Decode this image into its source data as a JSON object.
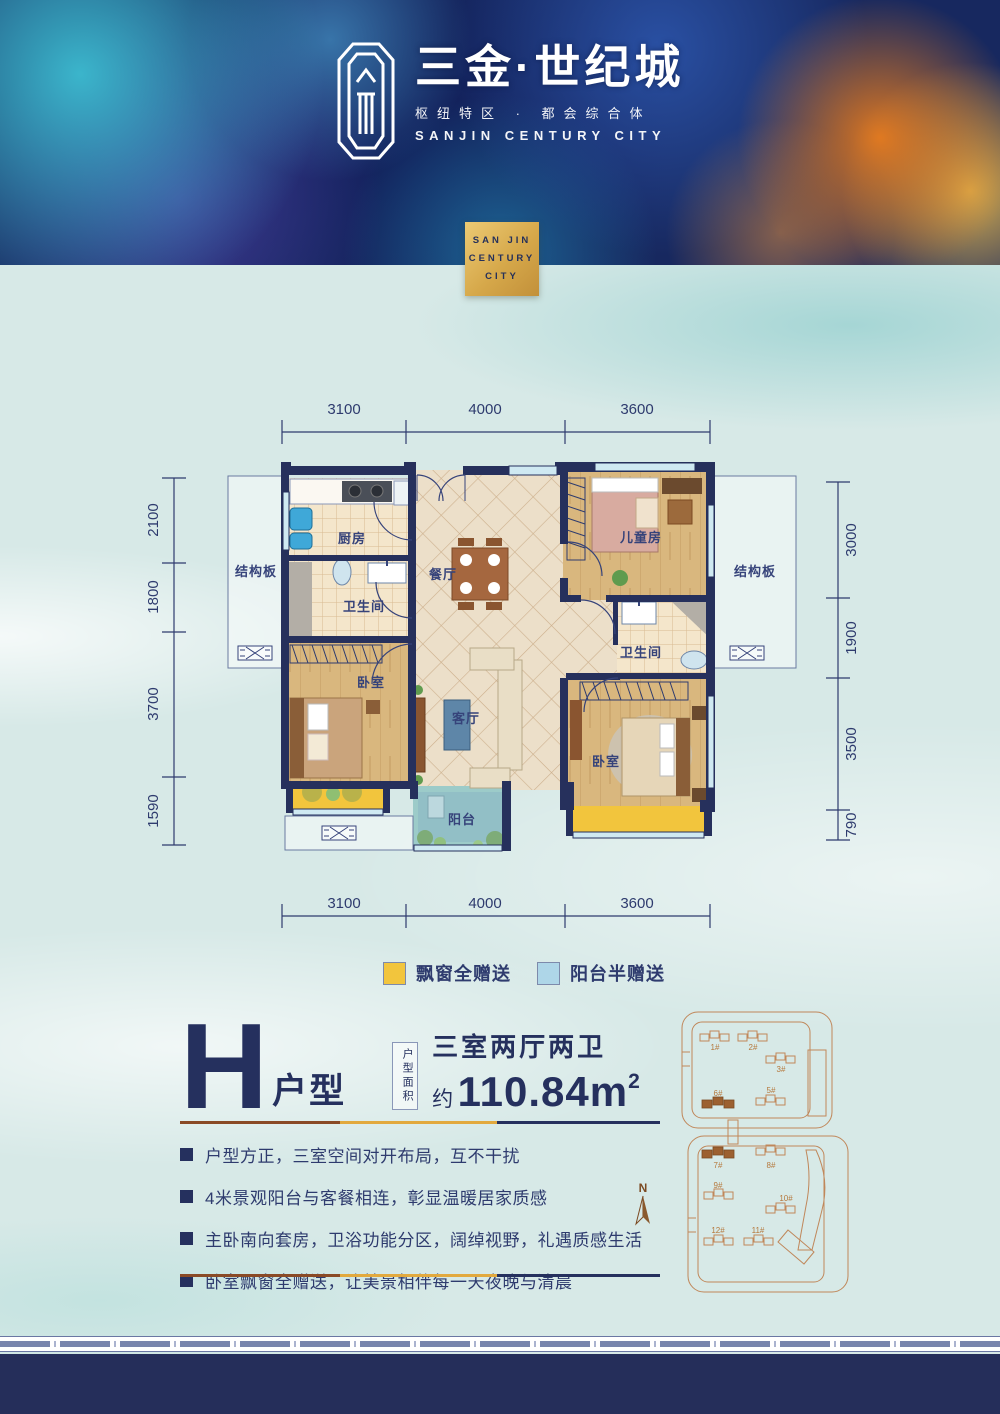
{
  "header": {
    "brand": "三金·世纪城",
    "tagline": "枢纽特区 · 都会综合体",
    "brand_en": "SANJIN CENTURY CITY",
    "badge": {
      "line1": "SAN JIN",
      "line2": "CENTURY",
      "line3": "CITY"
    }
  },
  "plan": {
    "dims": {
      "top": [
        "3100",
        "4000",
        "3600"
      ],
      "bottom": [
        "3100",
        "4000",
        "3600"
      ],
      "left": [
        "2100",
        "1800",
        "3700",
        "1590"
      ],
      "right": [
        "3000",
        "1900",
        "3500",
        "790"
      ]
    },
    "rooms": {
      "kitchen": "厨房",
      "bath1": "卫生间",
      "bath2": "卫生间",
      "dining": "餐厅",
      "living": "客厅",
      "balcony": "阳台",
      "bedroom_left": "卧室",
      "bedroom_right": "卧室",
      "kids": "儿童房",
      "slab_left": "结构板",
      "slab_right": "结构板"
    }
  },
  "legend": [
    {
      "label": "飘窗全赠送",
      "color": "#f2c53d"
    },
    {
      "label": "阳台半赠送",
      "color": "#aed6e8"
    }
  ],
  "unit": {
    "letter": "H",
    "type_label": "户型",
    "area_box": "户型面积",
    "rooms_desc": "三室两厅两卫",
    "area_prefix": "约",
    "area_value": "110.84m",
    "area_sup": "2"
  },
  "features": [
    "户型方正，三室空间对开布局，互不干扰",
    "4米景观阳台与客餐相连，彰显温暖居家质感",
    "主卧南向套房，卫浴功能分区，阔绰视野，礼遇质感生活",
    "卧室飘窗全赠送，让美景相伴每一天夜晚与清晨"
  ],
  "site_plan": {
    "compass": "N",
    "buildings": [
      "1#",
      "2#",
      "3#",
      "6#",
      "5#",
      "7#",
      "8#",
      "9#",
      "10#",
      "12#",
      "11#"
    ]
  },
  "colors": {
    "accent_navy": "#25305e",
    "legend_yellow": "#f2c53d",
    "legend_blue": "#aed6e8",
    "separator_brown": "#8a4a26",
    "separator_gold": "#e2a93e",
    "siteplan_tan": "#c0875a",
    "footer_navy": "#252e5a"
  }
}
